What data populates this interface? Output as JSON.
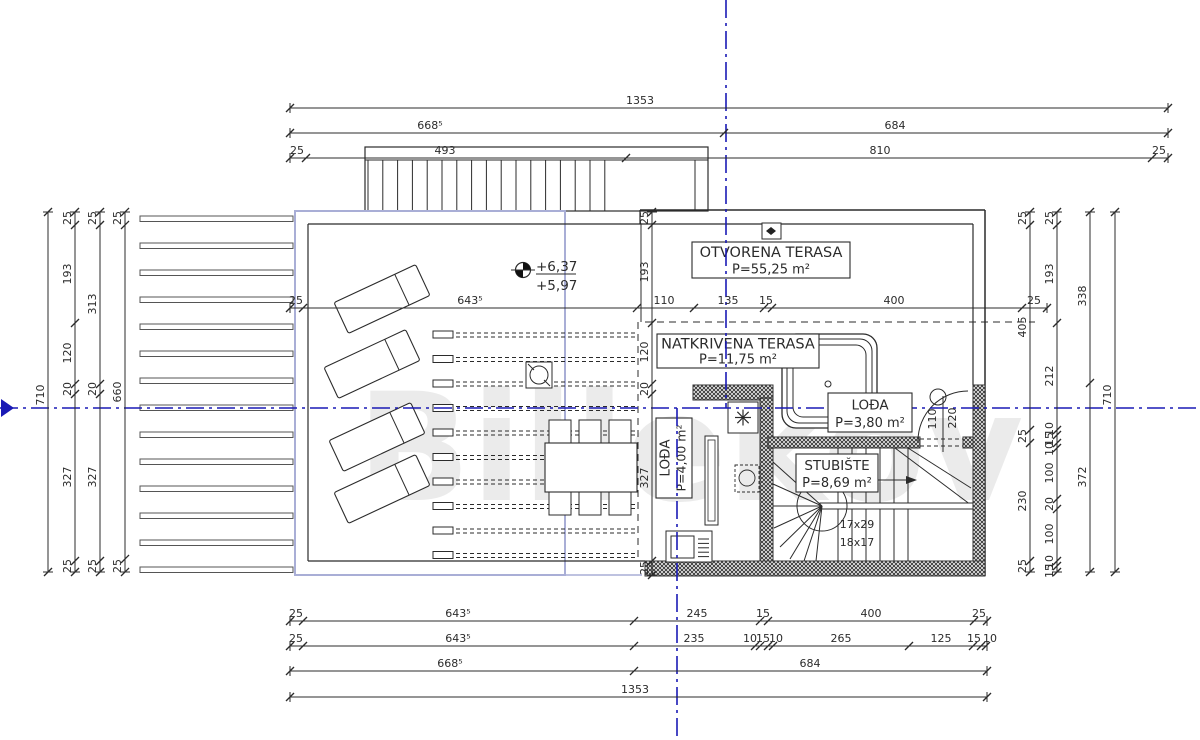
{
  "watermark": "Billekov",
  "colors": {
    "axis": "#1a1ab5",
    "line": "#2b2b2b",
    "blue_rect": "#a9aed6",
    "thin": "#555555"
  },
  "levels": {
    "upper": "+6,37",
    "lower": "+5,97"
  },
  "stair_note": [
    "17x29",
    "18x17"
  ],
  "rooms": [
    {
      "name": "OTVORENA TERASA",
      "area": "P=55,25 m²",
      "box": [
        692,
        242,
        158,
        36
      ],
      "rot": 0
    },
    {
      "name": "NATKRIVENA TERASA",
      "area": "P=11,75 m²",
      "box": [
        657,
        334,
        162,
        34
      ],
      "rot": 0
    },
    {
      "name": "LOĐA",
      "area": "P=3,80 m²",
      "box": [
        828,
        393,
        84,
        39
      ],
      "rot": 0
    },
    {
      "name": "LOĐA",
      "area": "P=4,00 m²",
      "box": [
        656,
        418,
        36,
        80
      ],
      "rot": -90
    },
    {
      "name": "STUBIŠTE",
      "area": "P=8,69 m²",
      "box": [
        796,
        454,
        82,
        38
      ],
      "rot": 0
    }
  ],
  "h_dims": [
    {
      "y": 108,
      "x1": 290,
      "x2": 1168,
      "ticks": [
        290,
        1168
      ],
      "labels": [
        {
          "t": "1353",
          "x": 640
        }
      ]
    },
    {
      "y": 133,
      "x1": 290,
      "x2": 1168,
      "ticks": [
        290,
        724,
        1168
      ],
      "labels": [
        {
          "t": "668⁵",
          "x": 430
        },
        {
          "t": "684",
          "x": 895
        }
      ]
    },
    {
      "y": 158,
      "x1": 290,
      "x2": 1168,
      "ticks": [
        290,
        306,
        626,
        1152,
        1168
      ],
      "labels": [
        {
          "t": "25",
          "x": 297
        },
        {
          "t": "493",
          "x": 445
        },
        {
          "t": "810",
          "x": 880
        },
        {
          "t": "25",
          "x": 1159
        }
      ]
    },
    {
      "y": 308,
      "x1": 290,
      "x2": 1047,
      "ticks": [
        290,
        303,
        637,
        694,
        764,
        772,
        1022,
        1047
      ],
      "labels": [
        {
          "t": "25",
          "x": 296
        },
        {
          "t": "643⁵",
          "x": 470
        },
        {
          "t": "110",
          "x": 664
        },
        {
          "t": "135",
          "x": 728
        },
        {
          "t": "15",
          "x": 766
        },
        {
          "t": "400",
          "x": 894
        },
        {
          "t": "25",
          "x": 1034
        }
      ]
    },
    {
      "y": 621,
      "x1": 290,
      "x2": 987,
      "ticks": [
        290,
        303,
        634,
        760,
        768,
        974,
        987
      ],
      "labels": [
        {
          "t": "25",
          "x": 296
        },
        {
          "t": "643⁵",
          "x": 458
        },
        {
          "t": "245",
          "x": 697
        },
        {
          "t": "15",
          "x": 763
        },
        {
          "t": "400",
          "x": 871
        },
        {
          "t": "25",
          "x": 979
        }
      ]
    },
    {
      "y": 646,
      "x1": 290,
      "x2": 987,
      "ticks": [
        290,
        303,
        634,
        755,
        760,
        768,
        773,
        909,
        973,
        981,
        986
      ],
      "labels": [
        {
          "t": "25",
          "x": 296
        },
        {
          "t": "643⁵",
          "x": 458
        },
        {
          "t": "235",
          "x": 694
        },
        {
          "t": "10",
          "x": 750
        },
        {
          "t": "15",
          "x": 763
        },
        {
          "t": "10",
          "x": 776
        },
        {
          "t": "265",
          "x": 841
        },
        {
          "t": "125",
          "x": 941
        },
        {
          "t": "15",
          "x": 974
        },
        {
          "t": "10",
          "x": 990
        }
      ]
    },
    {
      "y": 671,
      "x1": 290,
      "x2": 987,
      "ticks": [
        290,
        634,
        987
      ],
      "labels": [
        {
          "t": "668⁵",
          "x": 450
        },
        {
          "t": "684",
          "x": 810
        }
      ]
    },
    {
      "y": 697,
      "x1": 290,
      "x2": 987,
      "ticks": [
        290,
        987
      ],
      "labels": [
        {
          "t": "1353",
          "x": 635
        }
      ]
    }
  ],
  "v_dims": [
    {
      "x": 48,
      "y1": 212,
      "y2": 572,
      "ticks": [
        212,
        572
      ],
      "labels": [
        {
          "t": "710",
          "y": 395
        }
      ]
    },
    {
      "x": 75,
      "y1": 212,
      "y2": 572,
      "ticks": [
        212,
        225,
        323,
        384,
        394,
        561,
        572
      ],
      "labels": [
        {
          "t": "25",
          "y": 218
        },
        {
          "t": "193",
          "y": 274
        },
        {
          "t": "120",
          "y": 353
        },
        {
          "t": "20",
          "y": 389
        },
        {
          "t": "327",
          "y": 477
        },
        {
          "t": "25",
          "y": 566
        }
      ]
    },
    {
      "x": 100,
      "y1": 212,
      "y2": 572,
      "ticks": [
        212,
        225,
        384,
        394,
        561,
        572
      ],
      "labels": [
        {
          "t": "25",
          "y": 218
        },
        {
          "t": "313",
          "y": 304
        },
        {
          "t": "20",
          "y": 389
        },
        {
          "t": "327",
          "y": 477
        },
        {
          "t": "25",
          "y": 566
        }
      ]
    },
    {
      "x": 125,
      "y1": 212,
      "y2": 572,
      "ticks": [
        212,
        225,
        559,
        572
      ],
      "labels": [
        {
          "t": "25",
          "y": 218
        },
        {
          "t": "660",
          "y": 392
        },
        {
          "t": "25",
          "y": 566
        }
      ]
    },
    {
      "x": 652,
      "y1": 212,
      "y2": 575,
      "ticks": [
        212,
        225,
        323,
        384,
        394,
        561,
        575
      ],
      "labels": [
        {
          "t": "25",
          "y": 218
        },
        {
          "t": "193",
          "y": 272
        },
        {
          "t": "120",
          "y": 352
        },
        {
          "t": "20",
          "y": 389
        },
        {
          "t": "327",
          "y": 478
        },
        {
          "t": "25",
          "y": 568
        }
      ]
    },
    {
      "x": 1030,
      "y1": 212,
      "y2": 572,
      "ticks": [
        212,
        225,
        430,
        443,
        561,
        572
      ],
      "labels": [
        {
          "t": "25",
          "y": 218
        },
        {
          "t": "405",
          "y": 327
        },
        {
          "t": "25",
          "y": 436
        },
        {
          "t": "230",
          "y": 501
        },
        {
          "t": "25",
          "y": 566
        }
      ]
    },
    {
      "x": 1057,
      "y1": 212,
      "y2": 572,
      "ticks": [
        212,
        225,
        323,
        430,
        435,
        443,
        448,
        499,
        509,
        561,
        566,
        572
      ],
      "labels": [
        {
          "t": "25",
          "y": 218
        },
        {
          "t": "193",
          "y": 274
        },
        {
          "t": "212",
          "y": 376
        },
        {
          "t": "10",
          "y": 429
        },
        {
          "t": "15",
          "y": 439
        },
        {
          "t": "10",
          "y": 449
        },
        {
          "t": "100",
          "y": 473
        },
        {
          "t": "20",
          "y": 504
        },
        {
          "t": "100",
          "y": 534
        },
        {
          "t": "10",
          "y": 562
        },
        {
          "t": "15",
          "y": 571
        }
      ]
    },
    {
      "x": 1090,
      "y1": 212,
      "y2": 572,
      "ticks": [
        212,
        383,
        572
      ],
      "labels": [
        {
          "t": "338",
          "y": 296
        },
        {
          "t": "372",
          "y": 477
        }
      ]
    },
    {
      "x": 1115,
      "y1": 212,
      "y2": 572,
      "ticks": [
        212,
        572
      ],
      "labels": [
        {
          "t": "710",
          "y": 395
        }
      ]
    }
  ],
  "free_labels": [
    {
      "t": "110",
      "x": 936,
      "y": 419,
      "rot": -90
    },
    {
      "t": "220",
      "x": 956,
      "y": 418,
      "rot": -90
    }
  ]
}
